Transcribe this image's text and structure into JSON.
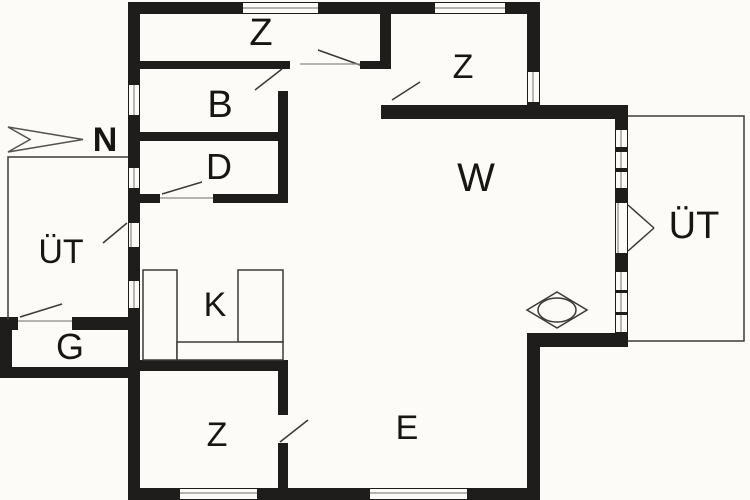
{
  "plan": {
    "title": "floor-plan",
    "rooms": {
      "bedroom_top_left": "Z",
      "bedroom_top_right": "Z",
      "bathroom": "B",
      "d_room": "D",
      "terrace_left": "ÜT",
      "terrace_right": "ÜT",
      "storage": "G",
      "kitchen": "K",
      "bedroom_bottom": "Z",
      "dining": "E",
      "living": "W",
      "north_mark": "N"
    },
    "symbols": {
      "north_arrow": "north-arrow-icon",
      "stove": "stove-icon",
      "kitchen_counter": "kitchen-counter",
      "door_swing": "door-swing-line"
    },
    "colors": {
      "wall": "#1e1d1b",
      "background": "#fcfbf7",
      "thin_line": "#3c3a36",
      "threshold": "#8b8a84"
    }
  }
}
